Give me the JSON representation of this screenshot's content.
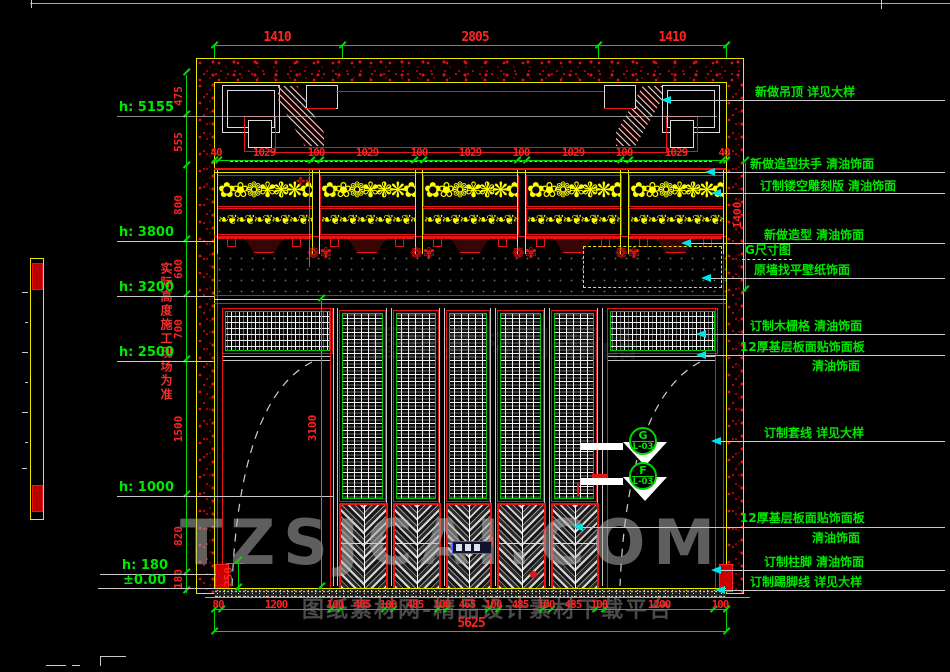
{
  "drawing": {
    "type": "interior-elevation-cad",
    "colors": {
      "dim_red": "#ff2222",
      "anno_green": "#00e800",
      "line_yellow": "#e8e800",
      "leader_cyan": "#00e5e5",
      "watermark_gray": "#b4b4b4"
    }
  },
  "dims": {
    "top_row1": [
      "1410",
      "2805",
      "1410"
    ],
    "top_row2": [
      "40",
      "1029",
      "100",
      "1029",
      "100",
      "1029",
      "100",
      "1029",
      "100",
      "1029",
      "40"
    ],
    "bottom_row": [
      "80",
      "1200",
      "100",
      "485",
      "100",
      "485",
      "100",
      "465",
      "100",
      "485",
      "100",
      "485",
      "100",
      "1200",
      "100"
    ],
    "total": "5625",
    "left_chain": [
      "475",
      "555",
      "800",
      "600",
      "700",
      "1500",
      "820",
      "180"
    ],
    "right_upper": "1400",
    "opening_height": "3100",
    "plinth": "250"
  },
  "levels": [
    "h: 5155",
    "h: 3800",
    "h: 3200",
    "h: 2500",
    "h: 1000",
    "h: 180",
    "±0.00"
  ],
  "left_note": "实际高度施工现场为准",
  "annotations": [
    "新做吊顶 详见大样",
    "新做造型扶手 清油饰面",
    "订制镂空雕刻版 清油饰面",
    "新做造型 清油饰面",
    "G尺寸图",
    "原墙找平壁纸饰面",
    "订制木栅格 清油饰面",
    "12厚基层板面贴饰面板",
    "清油饰面",
    "订制套线 详见大样",
    "12厚基层板面贴饰面板",
    "清油饰面",
    "订制柱脚 清油饰面",
    "订制踢脚线 详见大样"
  ],
  "callouts": [
    {
      "letter": "G",
      "code": "L-03"
    },
    {
      "letter": "F",
      "code": "L-03"
    }
  ],
  "watermark": {
    "main": "TZSJCAI.COM",
    "sub": "图纸素材网-精品设计素材下载平台"
  },
  "decor": {
    "floral": "✿❀❁✾❃❋✿❀❁✾❃❋✿❀❁✾",
    "scroll": "❧❦❧❦❧❦❧❦❧❦❧❦❧❦❧❦❧❦",
    "flower": "❁✾",
    "vine": "✤✤✤✤"
  }
}
